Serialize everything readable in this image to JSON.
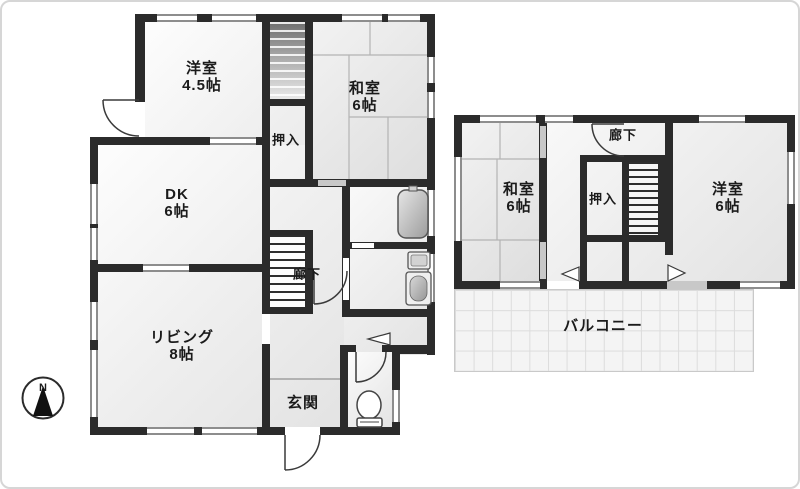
{
  "compass": {
    "north": "N"
  },
  "floor1": {
    "yoshitsu": {
      "name": "洋室",
      "size": "4.5帖"
    },
    "washitsu": {
      "name": "和室",
      "size": "6帖"
    },
    "oshiire": {
      "name": "押入"
    },
    "dk": {
      "name": "DK",
      "size": "6帖"
    },
    "rouka": {
      "name": "廊下"
    },
    "living": {
      "name": "リビング",
      "size": "8帖"
    },
    "genkan": {
      "name": "玄関"
    }
  },
  "floor2": {
    "rouka": {
      "name": "廊下"
    },
    "washitsu": {
      "name": "和室",
      "size": "6帖"
    },
    "oshiire": {
      "name": "押入"
    },
    "yoshitsu": {
      "name": "洋室",
      "size": "6帖"
    },
    "balcony": {
      "name": "バルコニー"
    }
  },
  "colors": {
    "wall": "#2b2b2b",
    "room_fill_light": "#fdfdfd",
    "room_fill_dark": "#e3e3e3",
    "tatami_line": "#b3b3b3",
    "window_rail": "#8d8d8d",
    "balcony_grid": "#dcdcdc",
    "door_arc": "#3a3a3a"
  }
}
